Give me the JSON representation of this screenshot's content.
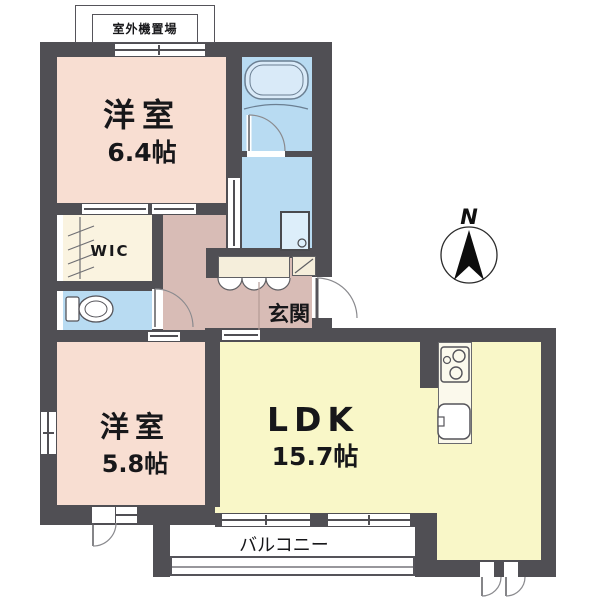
{
  "labels": {
    "outdoor_unit": "室外機置場",
    "compass_n": "N",
    "bedroom1_name": "洋室",
    "bedroom1_size": "6.4帖",
    "bedroom2_name": "洋室",
    "bedroom2_size": "5.8帖",
    "ldk_name": "LDK",
    "ldk_size": "15.7帖",
    "wic": "WIC",
    "entrance": "玄関",
    "balcony": "バルコニー"
  },
  "colors": {
    "wall": "#504f54",
    "bedroom": "#f8ded2",
    "hall": "#d8bcb6",
    "ldk": "#f9f7c8",
    "wet": "#b8dbf2",
    "wic": "#faf3e0",
    "cream": "#f5eedb",
    "counter": "#fbf9ec"
  }
}
